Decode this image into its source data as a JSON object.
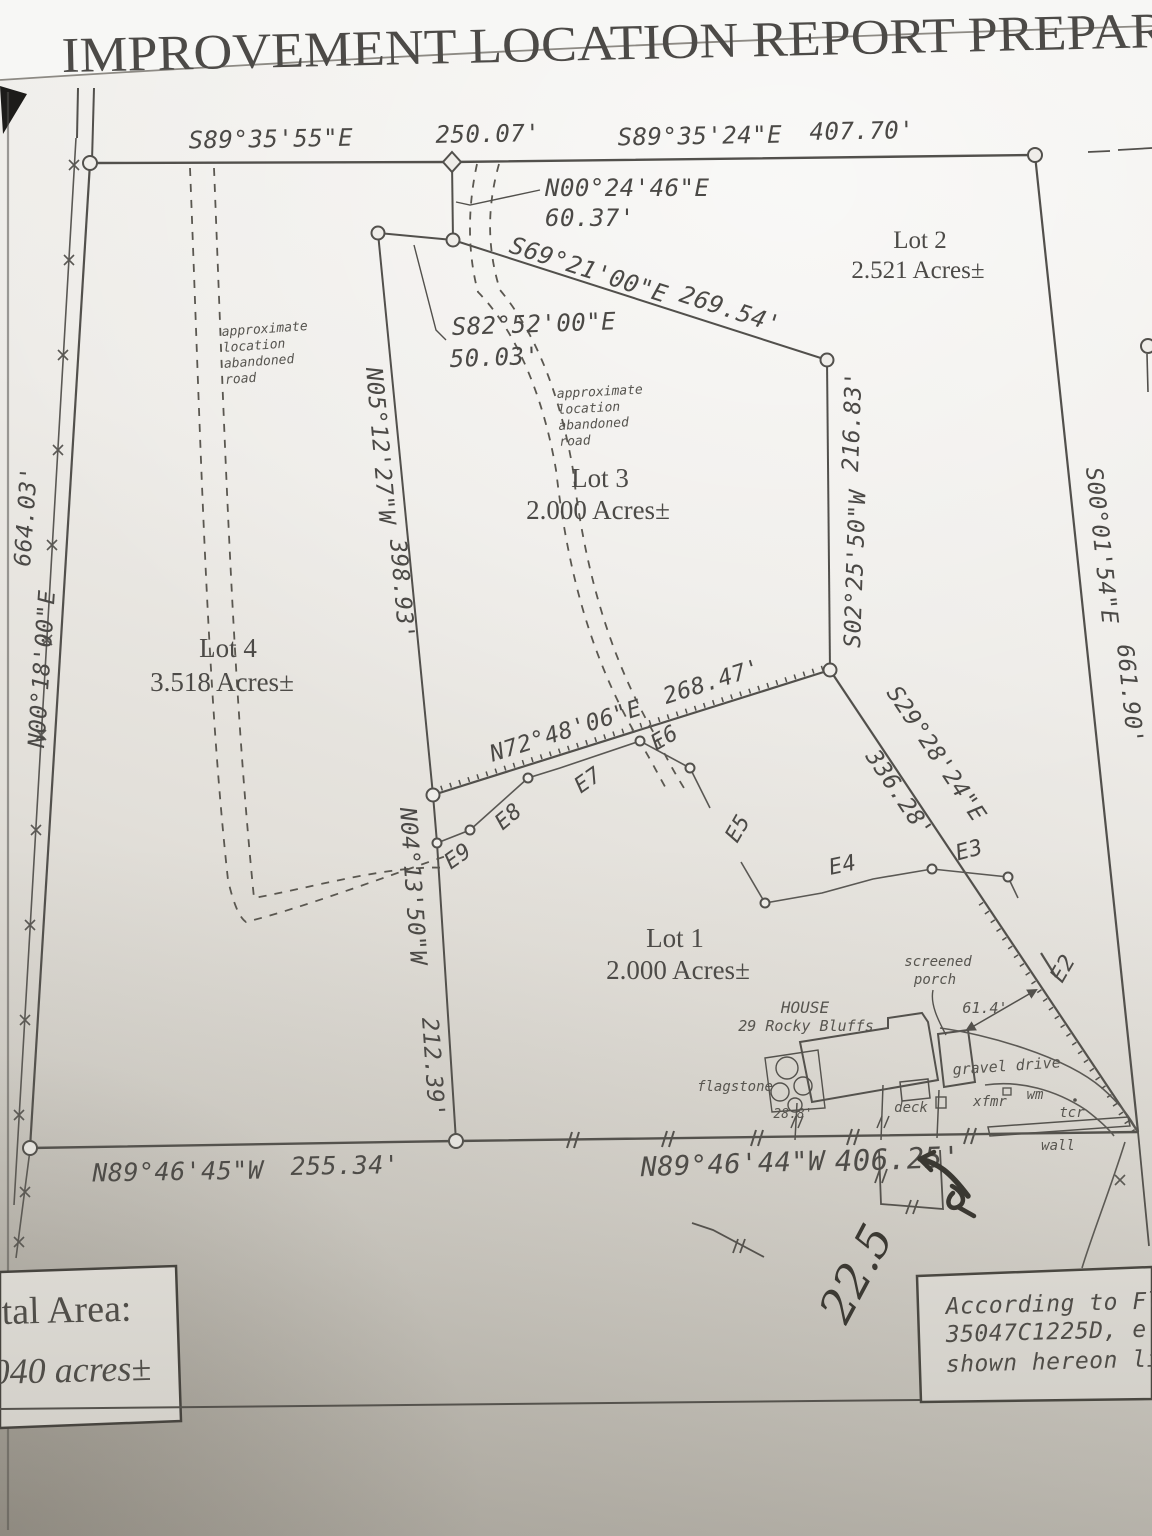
{
  "title": "IMPROVEMENT LOCATION REPORT PREPAR",
  "bearings": {
    "top_left_dir": "S89°35'55\"E",
    "top_left_dist": "250.07'",
    "top_right_dir": "S89°35'24\"E",
    "top_right_dist": "407.70'",
    "n0024_dir": "N00°24'46\"E",
    "n0024_dist": "60.37'",
    "s6921_dir": "S69°21'00\"E",
    "s6921_dist": "269.54'",
    "s8252_dir": "S82°52'00\"E",
    "s8252_dist": "50.03'",
    "left_dist": "664.03'",
    "left_dir": "N00°18'00\"E",
    "n0512_dir": "N05°12'27\"W",
    "n0512_dist": "398.93'",
    "s0225_dist": "216.83'",
    "s0225_dir": "S02°25'50\"W",
    "right_dir": "S00°01'54\"E",
    "right_dist": "661.90'",
    "n7248_dir": "N72°48'06\"E",
    "n7248_dist": "268.47'",
    "s2928_dir": "S29°28'24\"E",
    "s2928_dist": "336.28'",
    "n0413_dir": "N04°13'50\"W",
    "n0413_dist": "212.39'",
    "bottom_left_dir": "N89°46'45\"W",
    "bottom_left_dist": "255.34'",
    "bottom_right_dir": "N89°46'44\"W",
    "bottom_right_dist": "406.25'"
  },
  "lots": [
    {
      "name": "Lot 1",
      "area": "2.000 Acres±"
    },
    {
      "name": "Lot 2",
      "area": "2.521 Acres±"
    },
    {
      "name": "Lot 3",
      "area": "2.000 Acres±"
    },
    {
      "name": "Lot 4",
      "area": "3.518 Acres±"
    }
  ],
  "road_note": {
    "line1": "approximate",
    "line2": "location",
    "line3": "abandoned",
    "line4": "road"
  },
  "site": {
    "house_line1": "HOUSE",
    "house_line2": "29 Rocky Bluffs",
    "porch_line1": "screened",
    "porch_line2": "porch",
    "porch_dim": "61.4'",
    "flagstone": "flagstone",
    "flagstone_dim": "28.8'",
    "deck": "deck",
    "gravel_drive": "gravel drive",
    "xfmr": "xfmr",
    "wm": "wm",
    "tcr": "tcr",
    "wall": "wall"
  },
  "utility_points": {
    "e2": "E2",
    "e3": "E3",
    "e4": "E4",
    "e5": "E5",
    "e6": "E6",
    "e7": "E7",
    "e8": "E8",
    "e9": "E9"
  },
  "area_box": {
    "line1": "tal Area:",
    "line2": "040 acres±"
  },
  "flood_note": {
    "line1": "According to Flo",
    "line2": "35047C1225D, e",
    "line3": "shown hereon lie"
  },
  "handwriting": "22.5",
  "colors": {
    "ink": "#52504c",
    "paper": "#efede9",
    "handwriting": "#35332e"
  }
}
